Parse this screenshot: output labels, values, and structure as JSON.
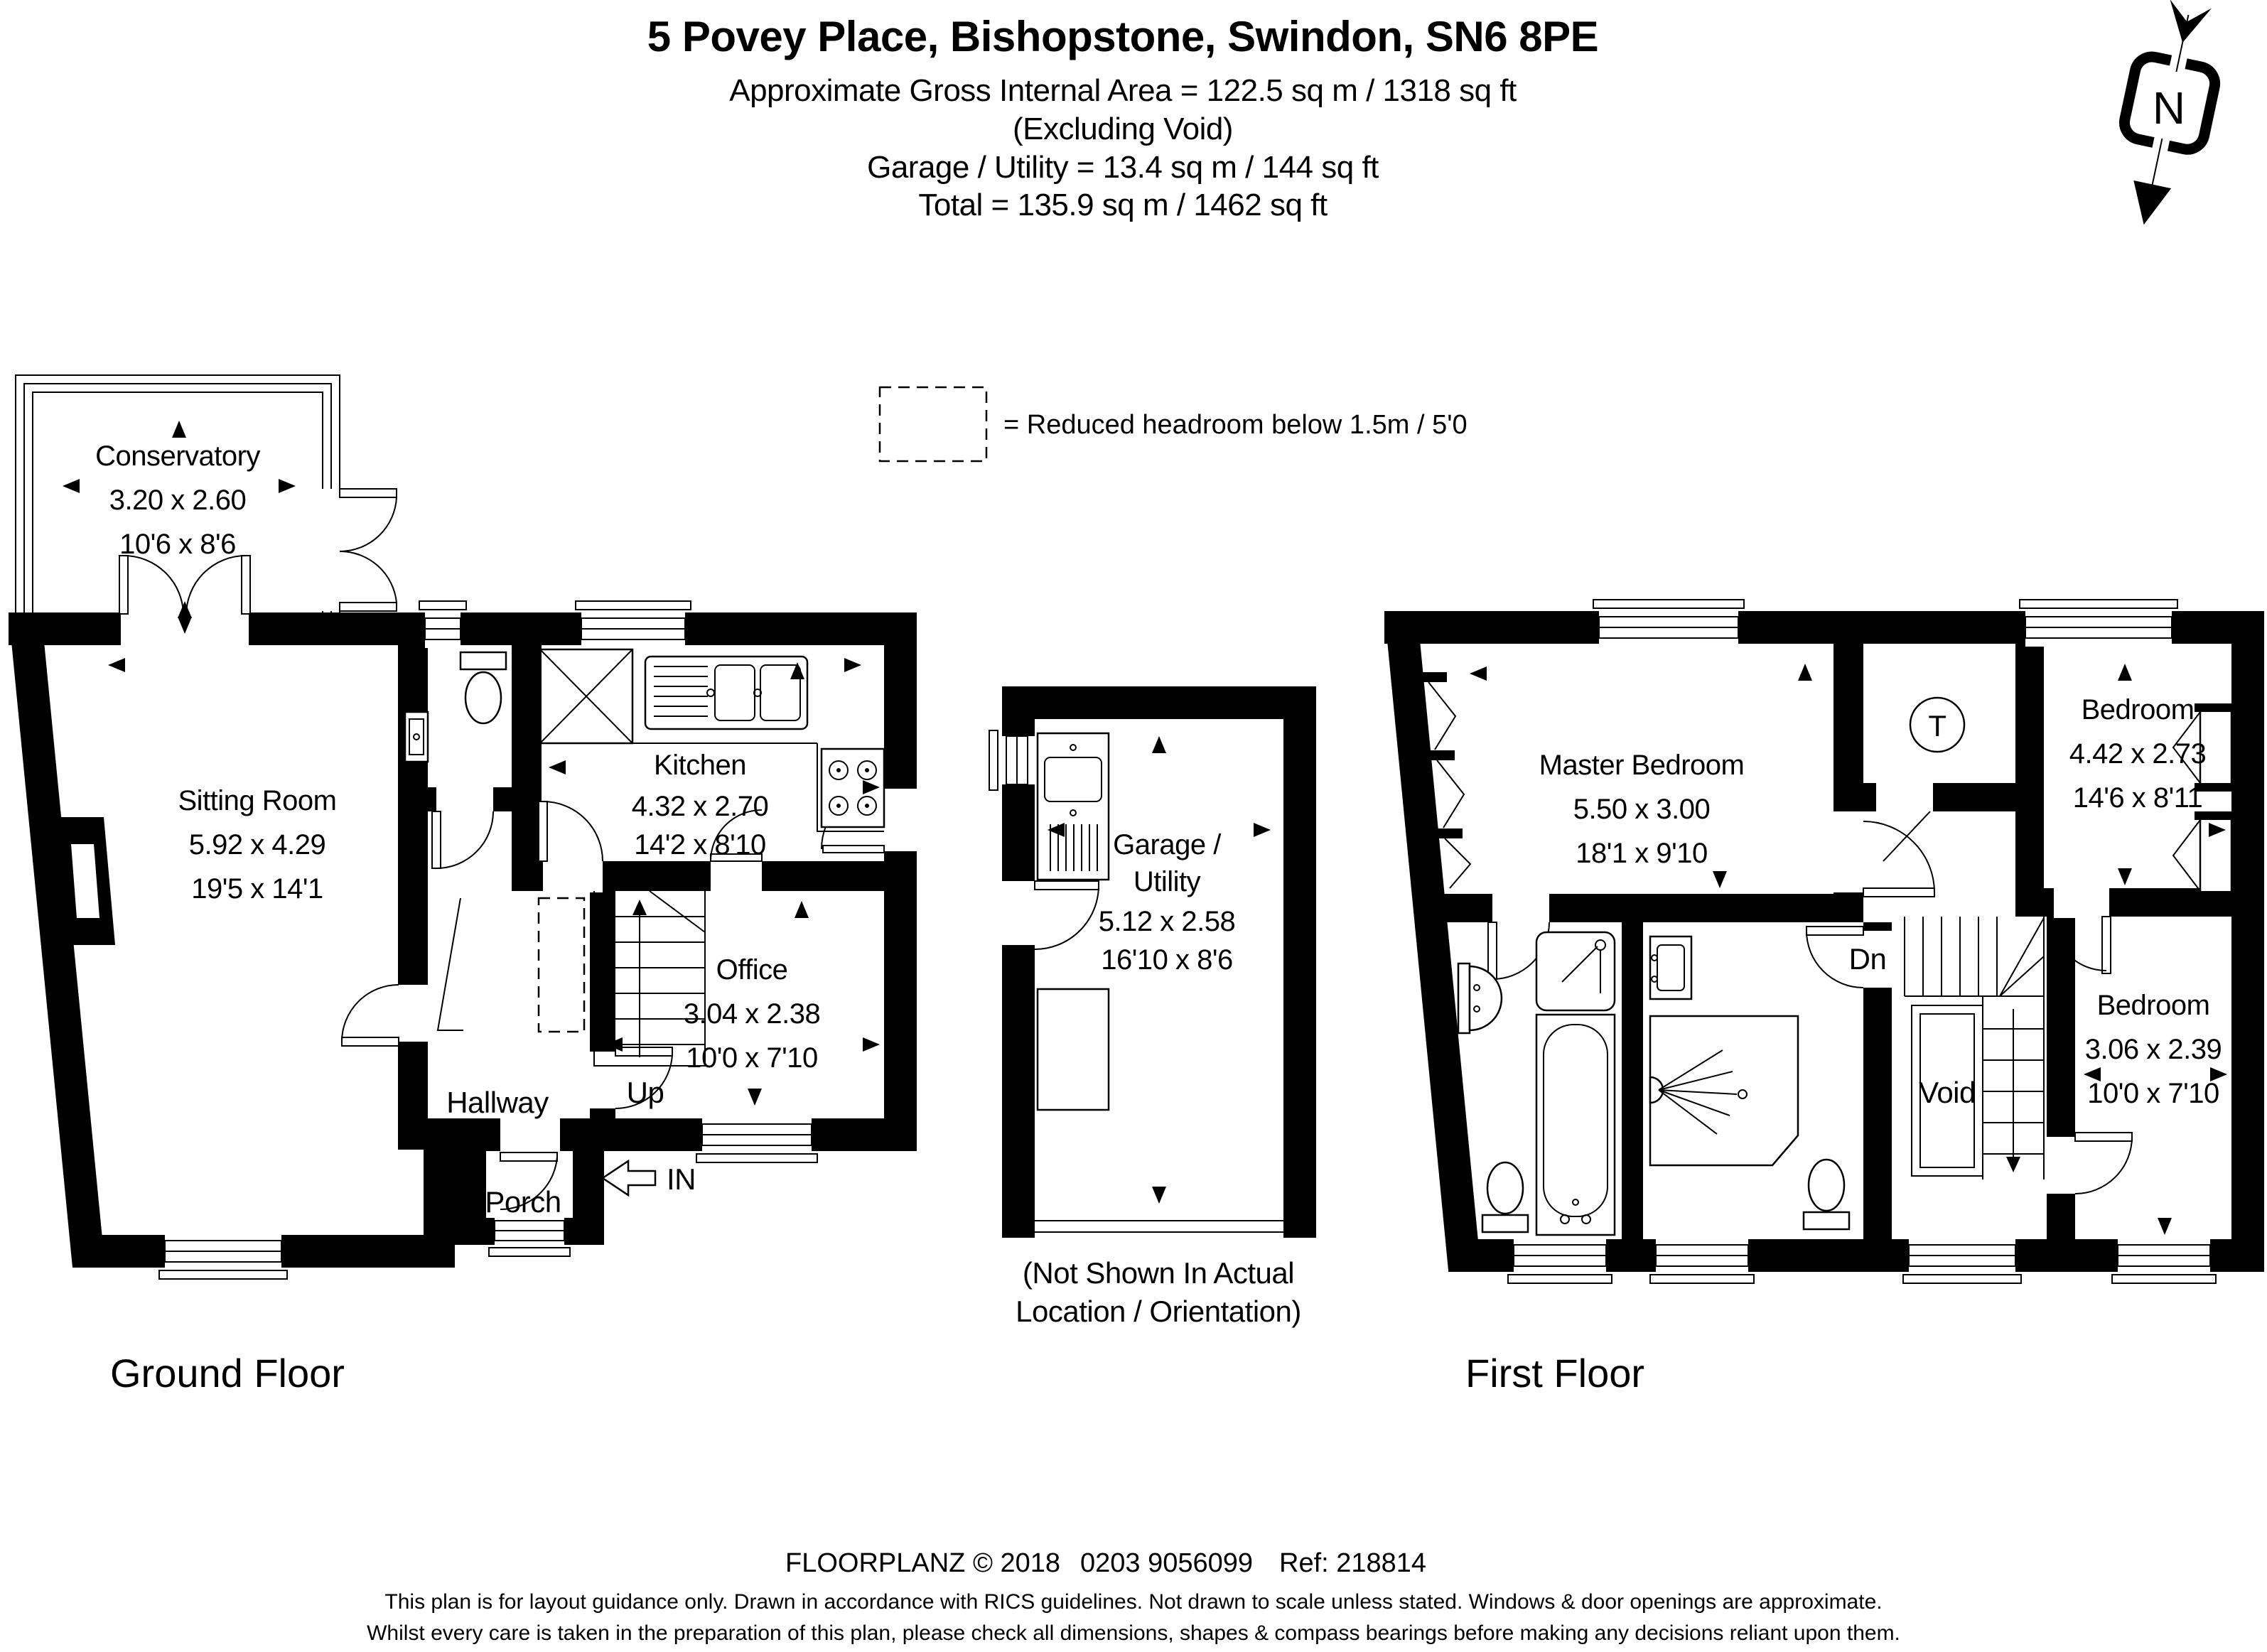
{
  "header": {
    "title": "5 Povey Place, Bishopstone, Swindon, SN6 8PE",
    "area": "Approximate Gross Internal Area = 122.5 sq m / 1318 sq ft",
    "excluding": "(Excluding Void)",
    "garage": "Garage / Utility = 13.4 sq m / 144 sq ft",
    "total": "Total = 135.9 sq m / 1462 sq ft"
  },
  "legend": {
    "reduced_headroom": "= Reduced headroom below 1.5m / 5'0"
  },
  "compass": {
    "north": "N"
  },
  "ground_floor": {
    "label": "Ground Floor",
    "conservatory": {
      "name": "Conservatory",
      "metric": "3.20 x 2.60",
      "imperial": "10'6 x 8'6"
    },
    "sitting_room": {
      "name": "Sitting Room",
      "metric": "5.92 x 4.29",
      "imperial": "19'5 x 14'1"
    },
    "kitchen": {
      "name": "Kitchen",
      "metric": "4.32 x 2.70",
      "imperial": "14'2 x 8'10"
    },
    "office": {
      "name": "Office",
      "metric": "3.04 x 2.38",
      "imperial": "10'0 x 7'10"
    },
    "hallway": "Hallway",
    "porch": "Porch",
    "stairs": "Up",
    "entrance": "IN"
  },
  "garage": {
    "name_line1": "Garage /",
    "name_line2": "Utility",
    "metric": "5.12 x 2.58",
    "imperial": "16'10 x 8'6",
    "note_line1": "(Not Shown In Actual",
    "note_line2": "Location / Orientation)"
  },
  "first_floor": {
    "label": "First Floor",
    "master_bedroom": {
      "name": "Master Bedroom",
      "metric": "5.50 x 3.00",
      "imperial": "18'1 x 9'10"
    },
    "bedroom_2": {
      "name": "Bedroom",
      "metric": "4.42 x 2.73",
      "imperial": "14'6 x 8'11"
    },
    "bedroom_3": {
      "name": "Bedroom",
      "metric": "3.06 x 2.39",
      "imperial": "10'0 x 7'10"
    },
    "void": "Void",
    "stairs": "Dn",
    "tank": "T"
  },
  "footer": {
    "brand": "FLOORPLANZ © 2018",
    "phone": "0203 9056099",
    "ref": "Ref: 218814",
    "disclaimer_line1": "This plan is for layout guidance only. Drawn in accordance with RICS guidelines. Not drawn to scale unless stated. Windows & door openings are approximate.",
    "disclaimer_line2": "Whilst every care is taken in the preparation of this plan, please check all dimensions, shapes & compass bearings before making any decisions reliant upon them."
  }
}
